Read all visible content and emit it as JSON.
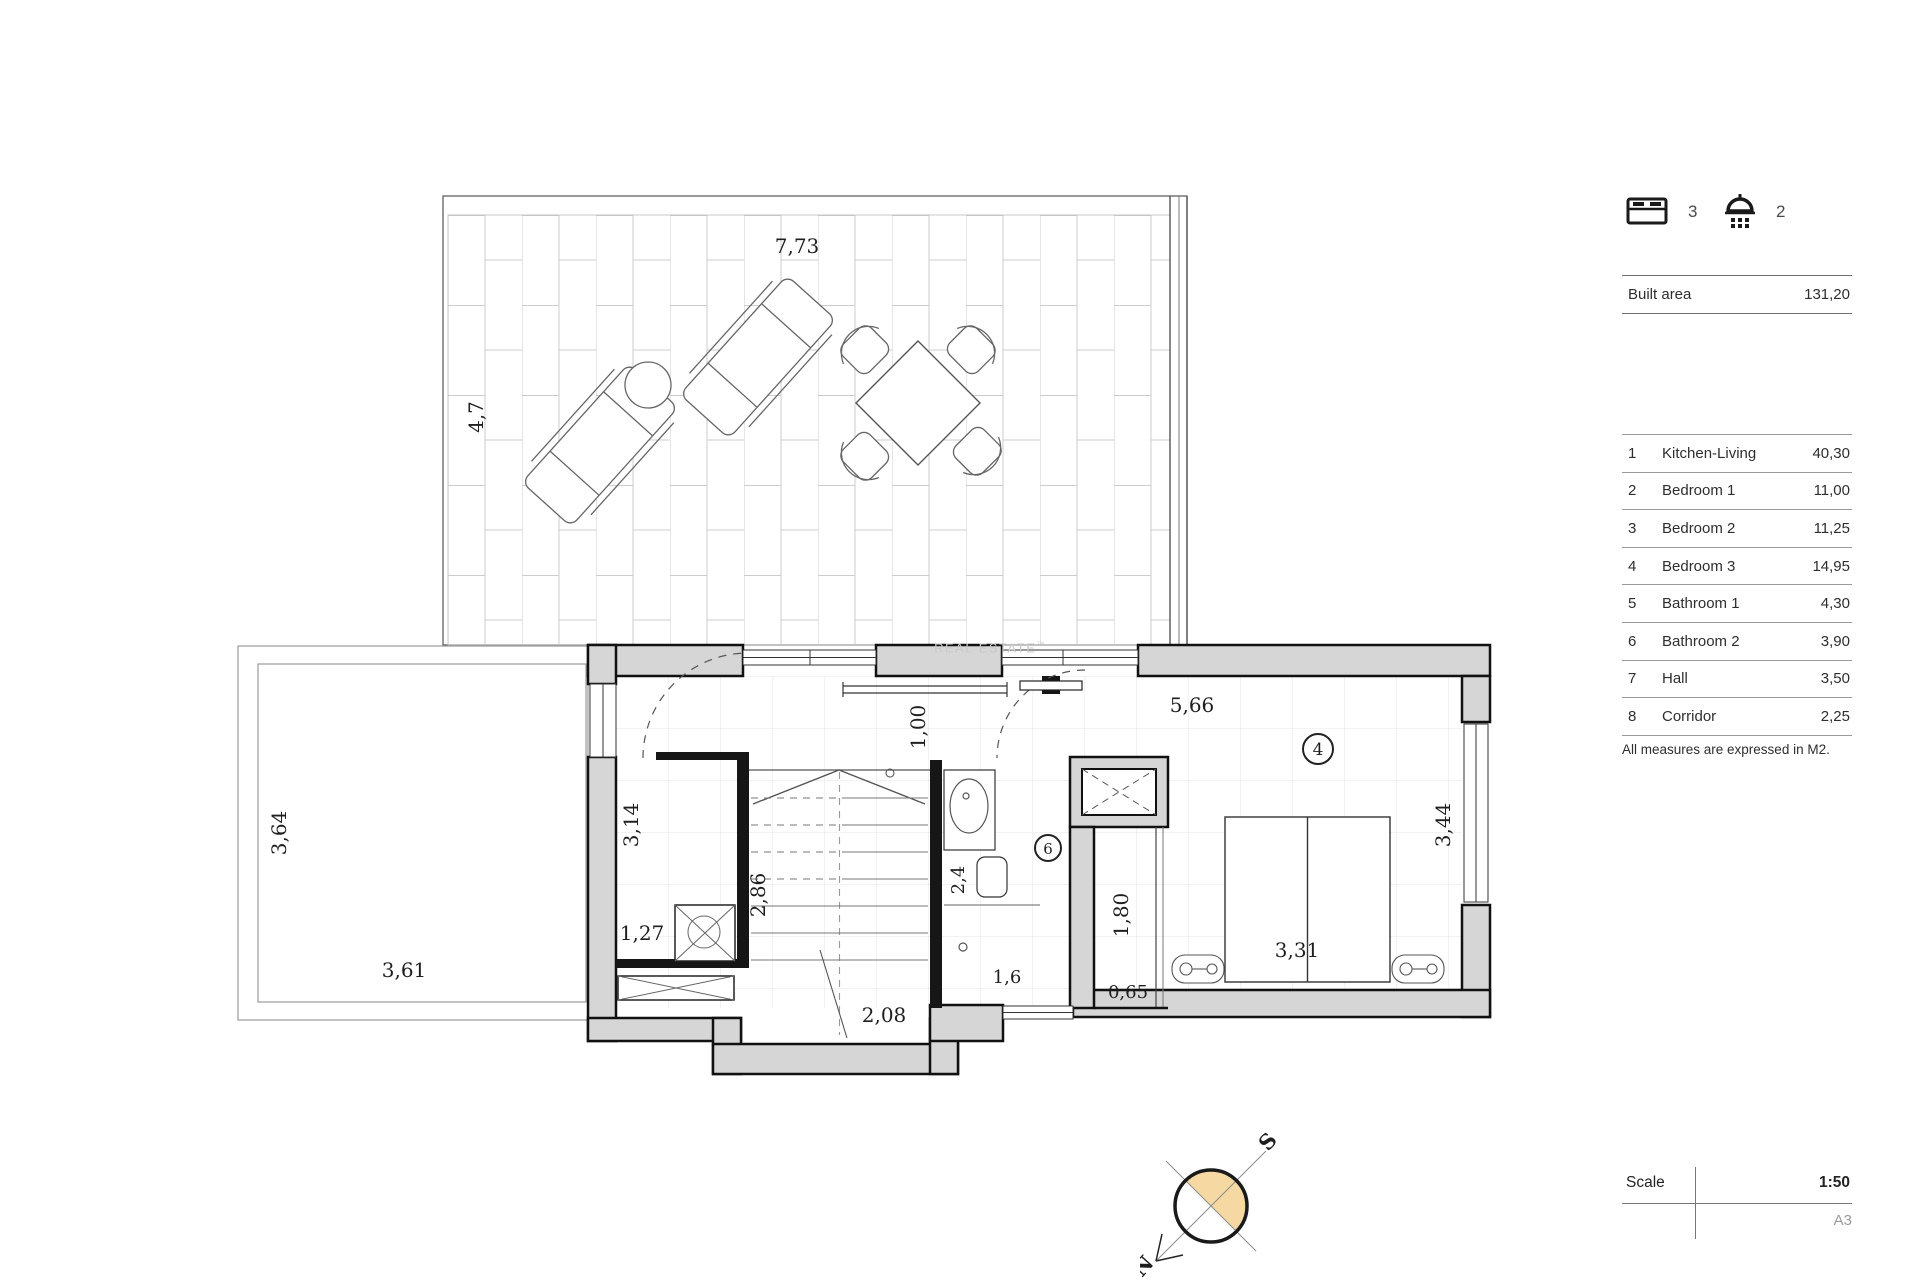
{
  "colors": {
    "wall_fill": "#d6d6d6",
    "wall_stroke": "#111111",
    "compass_fill": "#f6d9a2",
    "grid_line": "#e4e4e4",
    "tile_line": "#cccccc"
  },
  "summary": {
    "bedrooms": "3",
    "bathrooms": "2"
  },
  "built_area": {
    "label": "Built area",
    "value": "131,20"
  },
  "rooms": [
    {
      "num": "1",
      "name": "Kitchen-Living",
      "area": "40,30"
    },
    {
      "num": "2",
      "name": "Bedroom 1",
      "area": "11,00"
    },
    {
      "num": "3",
      "name": "Bedroom 2",
      "area": "11,25"
    },
    {
      "num": "4",
      "name": "Bedroom 3",
      "area": "14,95"
    },
    {
      "num": "5",
      "name": "Bathroom 1",
      "area": "4,30"
    },
    {
      "num": "6",
      "name": "Bathroom 2",
      "area": "3,90"
    },
    {
      "num": "7",
      "name": "Hall",
      "area": "3,50"
    },
    {
      "num": "8",
      "name": "Corridor",
      "area": "2,25"
    }
  ],
  "note": "All measures are expressed in M2.",
  "scale": {
    "label": "Scale",
    "value": "1:50",
    "paper": "A3"
  },
  "compass": {
    "north": "N",
    "south": "S"
  },
  "watermark": {
    "text": "REAL ESTATE",
    "tm": "™"
  },
  "plan": {
    "dims": {
      "terrace_w": "7,73",
      "terrace_h": "4,7",
      "pool_h": "3,64",
      "pool_w": "3,61",
      "bath1_h": "3,14",
      "bath1_w": "1,27",
      "stairs_h": "2,86",
      "stairs_w": "2,08",
      "corridor_w": "1,00",
      "bedroom_w": "5,66",
      "wc": "2,4",
      "window_w": "1,6",
      "wardrobe_h": "1,80",
      "wardrobe_w": "0,65",
      "bed_w": "3,31",
      "bedroom_h": "3,44"
    },
    "markers": {
      "bedroom3": "4",
      "bathroom2": "6"
    }
  }
}
